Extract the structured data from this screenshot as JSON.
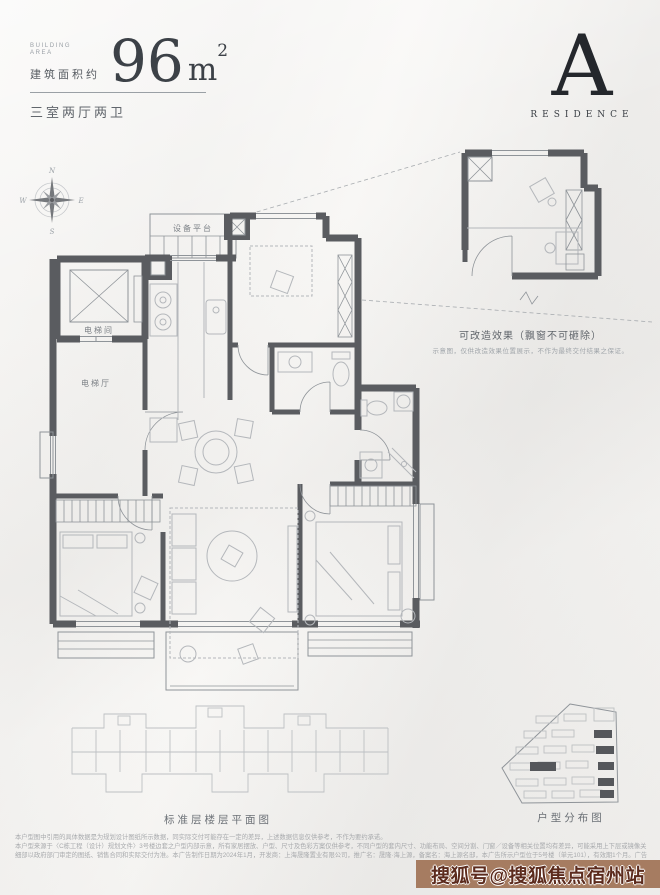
{
  "header": {
    "building_area_caps_line1": "BUILDING",
    "building_area_caps_line2": "AREA",
    "area_prefix": "建筑面积约",
    "area_value": "96",
    "area_unit": "m",
    "area_exponent": "2",
    "layout_desc": "三室两厅两卫"
  },
  "brand": {
    "letter": "A",
    "name": "RESIDENCE"
  },
  "compass": {
    "north": "N",
    "south": "S",
    "east": "E",
    "west": "W"
  },
  "plan_labels": {
    "equipment_platform": "设备平台",
    "elevator_room": "电梯间",
    "elevator_hall": "电梯厅"
  },
  "inset": {
    "title": "可改造效果（飘窗不可砸除）",
    "note": "示意图，仅供改造效果位置展示，不作为最终交付结果之保证。"
  },
  "footer": {
    "standard_floor_caption": "标准层楼层平面图",
    "distribution_caption": "户型分布图"
  },
  "disclaimer": {
    "line1": "本户型图中引用的具体数据是为规划设计图纸所示数据，同实际交付可能存在一定的差异，上述数据信息仅供参考，不作为要约承诺。",
    "line2": "本户型来源于〈C栋工程（设计）规划文件〉3号楼边套之户型内部示意，所有家居摆放、户型、尺寸及色彩方案仅供参考，不同户型的套内尺寸、功能布局、空间分割、门窗／设备等相关位置均有差异，可能采用上下层或镜像关系，相邻户型及墙体、管井、设备平台、烟道结构、落水管等位置不同，",
    "line3": "细部以政府部门审定的图纸、销售合同和实际交付为准。本广告制作日期为2024年1月，开发商：上海晟隆置业有限公司，推广名：晟隆·海上源，备案名：海上源名邸，本广告所示户型位于5号楼（单元101），有效期1个月。广告。"
  },
  "watermark": {
    "text": "搜狐号@搜狐焦点宿州站"
  },
  "colors": {
    "wall": "#5a5c60",
    "accent_band": "#a67c61",
    "page_bg": "#f3f2f0"
  }
}
